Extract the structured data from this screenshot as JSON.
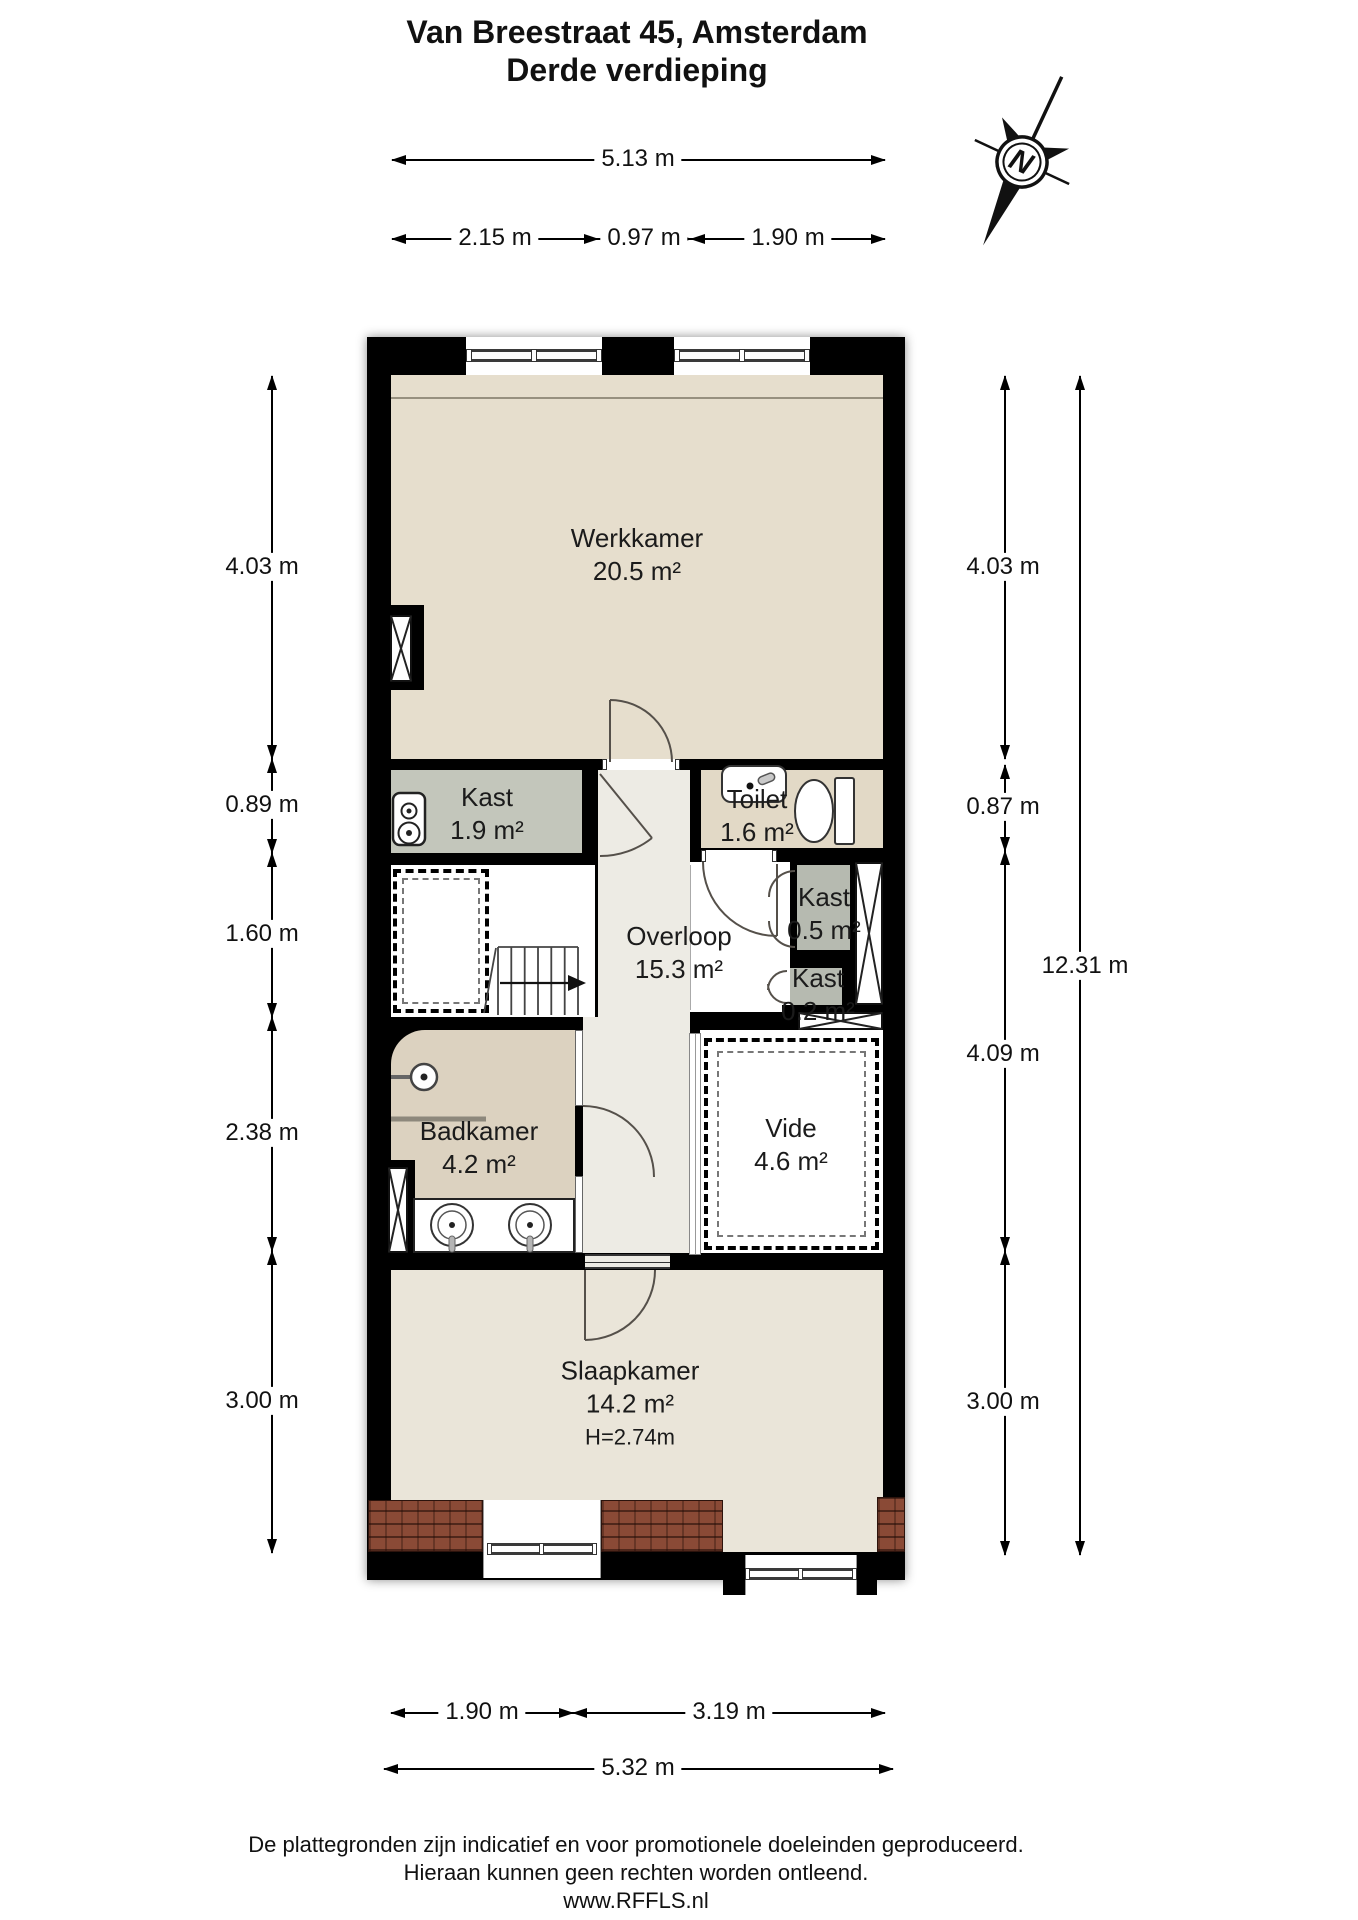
{
  "title": {
    "line1": "Van Breestraat 45, Amsterdam",
    "line2": "Derde verdieping"
  },
  "compass": {
    "north_label": "N"
  },
  "rooms": {
    "werkkamer": {
      "name": "Werkkamer",
      "area": "20.5 m²"
    },
    "kast_groot": {
      "name": "Kast",
      "area": "1.9 m²"
    },
    "toilet": {
      "name": "Toilet",
      "area": "1.6 m²"
    },
    "overloop": {
      "name": "Overloop",
      "area": "15.3 m²"
    },
    "kast_05": {
      "name": "Kast",
      "area": "0.5 m²"
    },
    "kast_02": {
      "name": "Kast",
      "area": "0.2 m²"
    },
    "badkamer": {
      "name": "Badkamer",
      "area": "4.2 m²"
    },
    "vide": {
      "name": "Vide",
      "area": "4.6 m²"
    },
    "slaapkamer": {
      "name": "Slaapkamer",
      "area": "14.2 m²",
      "ceiling_height": "H=2.74m"
    }
  },
  "dimensions": {
    "top_total": "5.13 m",
    "top_segments": [
      "2.15 m",
      "0.97 m",
      "1.90 m"
    ],
    "left_segments": [
      "4.03 m",
      "0.89 m",
      "1.60 m",
      "2.38 m",
      "3.00 m"
    ],
    "right_segments": [
      "4.03 m",
      "0.87 m",
      "4.09 m",
      "3.00 m"
    ],
    "right_total": "12.31 m",
    "bottom_segments": [
      "1.90 m",
      "3.19 m"
    ],
    "bottom_total": "5.32 m"
  },
  "footer": {
    "line1": "De plattegronden zijn indicatief en voor promotionele doeleinden geproduceerd.",
    "line2": "Hieraan kunnen geen rechten worden ontleend.",
    "line3": "www.RFFLS.nl"
  },
  "colors": {
    "wall": "#000000",
    "werkkamer_floor": "#e6decd",
    "toilet_floor": "#e2d9c6",
    "kast_floor": "#c3c6bb",
    "kast_small_floor": "#b6bab0",
    "overloop_floor": "#edebe4",
    "badkamer_floor": "#dcd2c0",
    "slaapkamer_floor": "#eae5d9",
    "vide_floor": "#ffffff",
    "roof_tiles": "#8a4a36"
  }
}
